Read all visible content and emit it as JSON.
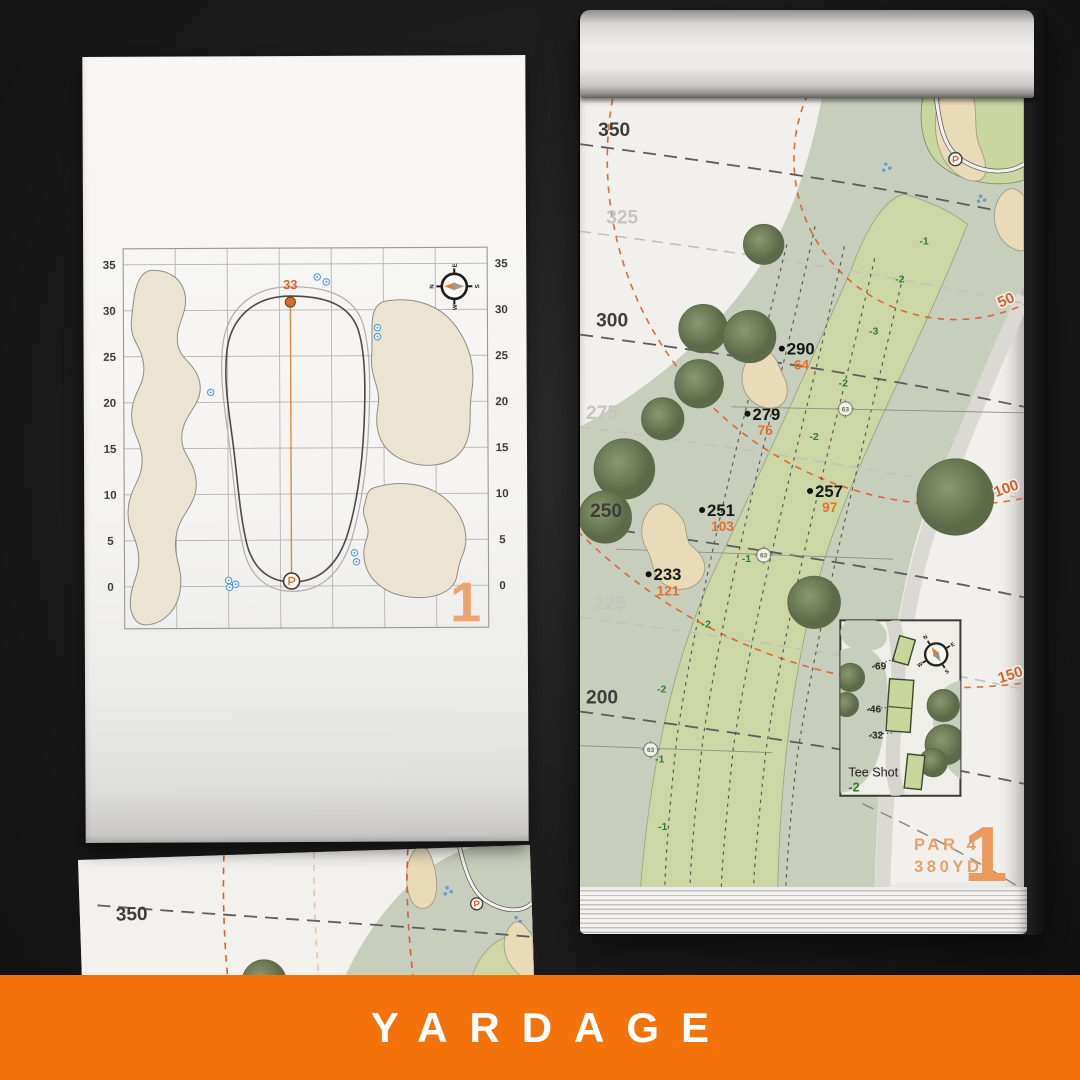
{
  "banner": {
    "title": "YARDAGE"
  },
  "left_page": {
    "hole_number": "1",
    "pin_label": "33",
    "grid_labels": [
      "35",
      "30",
      "25",
      "20",
      "15",
      "10",
      "5",
      "0"
    ],
    "compass": {
      "n": "N",
      "e": "E",
      "s": "S",
      "w": "W"
    }
  },
  "right_page": {
    "hole_number": "1",
    "par_label": "PAR 4",
    "yardage_label": "380YD",
    "yard_lines": [
      "350",
      "325",
      "300",
      "275",
      "250",
      "225",
      "200"
    ],
    "arc_labels": [
      "50",
      "100",
      "150"
    ],
    "markers": [
      {
        "from_tee": "290",
        "to_green": "64"
      },
      {
        "from_tee": "279",
        "to_green": "75"
      },
      {
        "from_tee": "257",
        "to_green": "97"
      },
      {
        "from_tee": "251",
        "to_green": "103"
      },
      {
        "from_tee": "233",
        "to_green": "121"
      }
    ],
    "sprinkler_labels": [
      "63",
      "63",
      "63"
    ],
    "elevation_labels": [
      "-1",
      "-2",
      "-3",
      "-2",
      "-2",
      "-1",
      "-2",
      "-2",
      "-1",
      "-1"
    ],
    "tee_inset": {
      "title": "Tee Shot",
      "elevation": "-2",
      "tee_distances": [
        "-69",
        "-46",
        "-32"
      ],
      "compass": {
        "n": "N",
        "e": "E",
        "s": "S",
        "w": "W"
      }
    }
  },
  "bottom_page": {
    "yard_lines": [
      "350",
      "325"
    ]
  },
  "colors": {
    "accent_orange": "#f3720a",
    "peach": "#eb9f67",
    "marker_orange": "#e4702c",
    "arc_orange": "#d95f28",
    "fairway_green": "#cdd7a5",
    "rough_green": "#c8cebc",
    "tree_green": "#72805a",
    "sand": "#eadbb8",
    "elevation_green": "#35793a",
    "sprinkler_blue": "#5b9bd5",
    "paper": "#f1f0ec"
  }
}
